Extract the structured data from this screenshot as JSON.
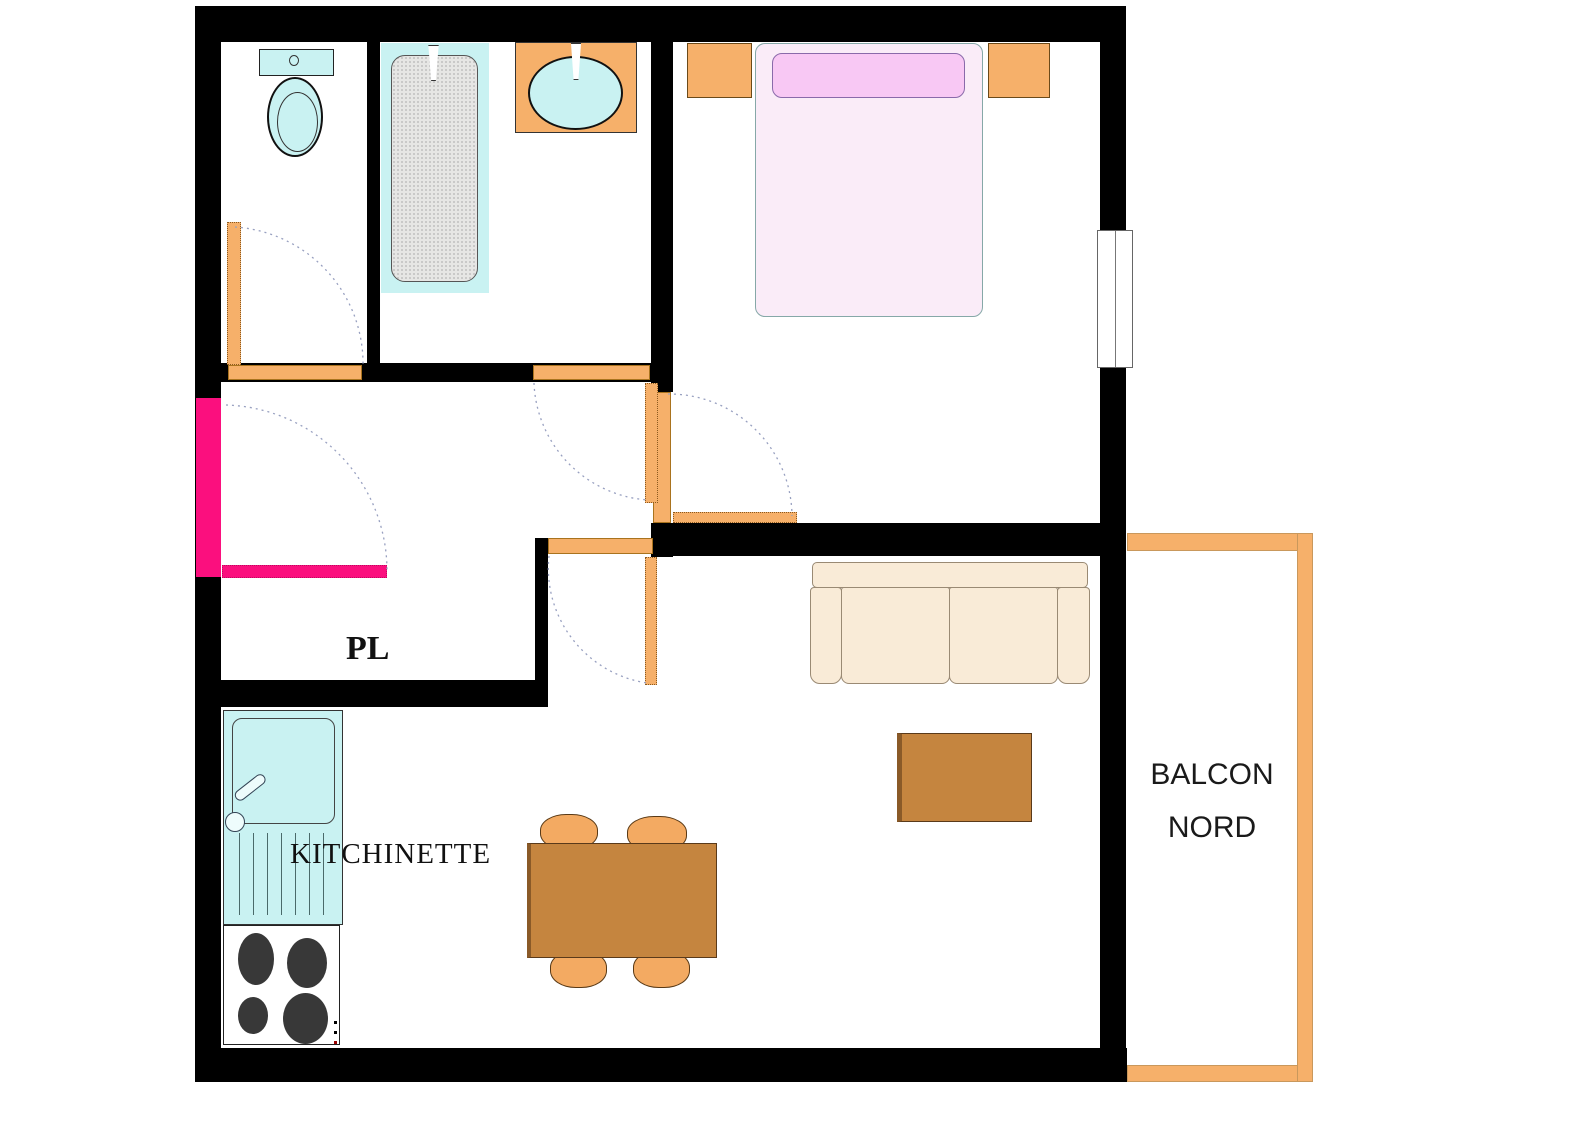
{
  "labels": {
    "closet": "PL",
    "kitchen": "KITCHINETTE",
    "balcony_line1": "BALCON",
    "balcony_line2": "NORD"
  },
  "colors": {
    "wall": "#000000",
    "door": "#F6B06A",
    "entrance_door": "#FB0F7E",
    "fixture_cyan": "#C9F2F2",
    "bed": "#FAECF8",
    "pillow": "#F8C8F4",
    "sofa": "#F9EBD7",
    "table_brown": "#C5853F",
    "stool": "#F3AA62",
    "burner": "#383838",
    "arc": "#98A0C0",
    "tub_gray": "#E6E6E4"
  }
}
